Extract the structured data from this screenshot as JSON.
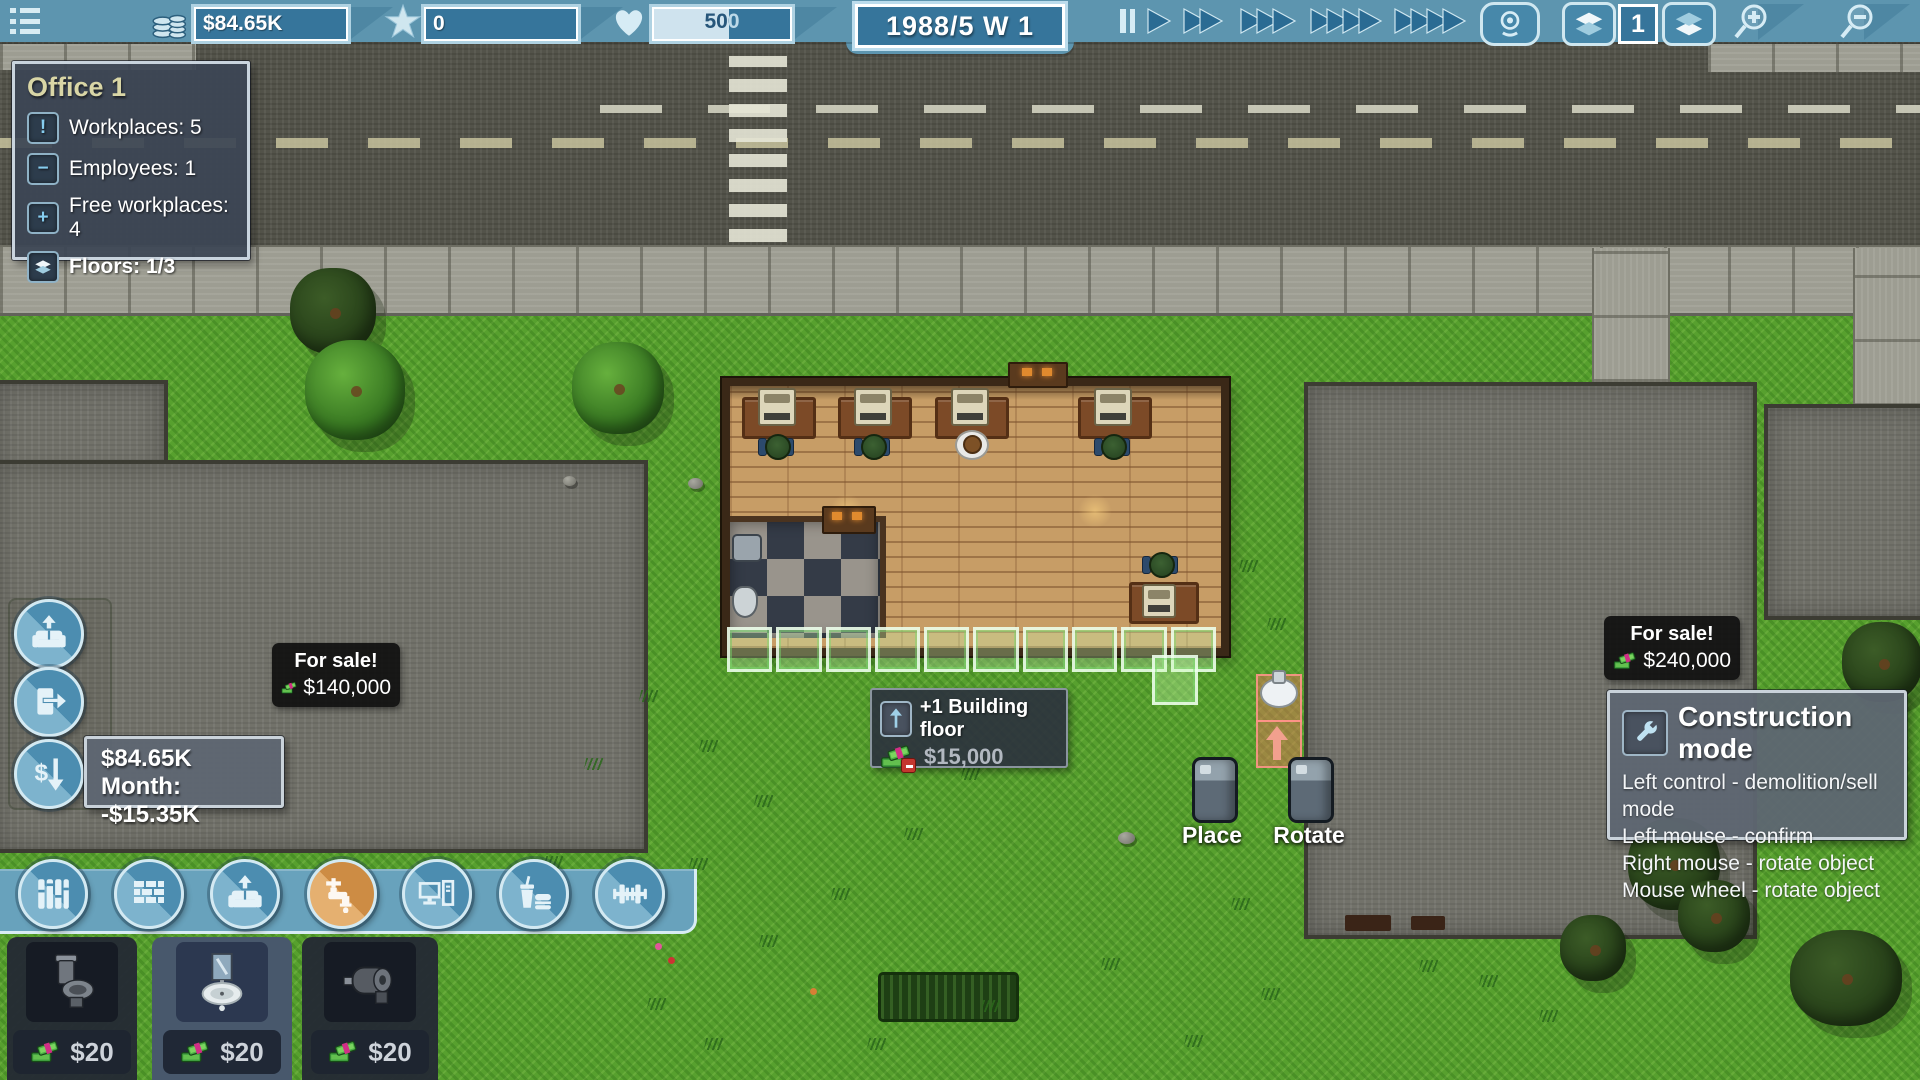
{
  "topbar": {
    "money": "$84.65K",
    "reputation": "0",
    "health": "500",
    "health_fill_pct": 55,
    "date": "1988/5 W 1",
    "floor": "1"
  },
  "office_panel": {
    "title": "Office 1",
    "rows": [
      {
        "icon": "exclamation",
        "label": "Workplaces: 5"
      },
      {
        "icon": "minus",
        "label": "Employees: 1"
      },
      {
        "icon": "plus",
        "label": "Free workplaces: 4"
      },
      {
        "icon": "layers",
        "label": "Floors: 1/3"
      }
    ]
  },
  "finance": {
    "balance": "$84.65K",
    "month": "Month: -$15.35K"
  },
  "sale_left": {
    "title": "For sale!",
    "price": "$140,000"
  },
  "sale_right": {
    "title": "For sale!",
    "price": "$240,000"
  },
  "floor_tooltip": {
    "label": "+1 Building floor",
    "price": "$15,000"
  },
  "construction": {
    "title": "Construction mode",
    "lines": [
      "Left control - demolition/sell mode",
      "Left mouse - confirm",
      "Right mouse - rotate object",
      "Mouse wheel - rotate object"
    ]
  },
  "touch": {
    "place": "Place",
    "rotate": "Rotate"
  },
  "toolbar": {
    "categories": [
      "flooring",
      "walls",
      "furniture",
      "plumbing",
      "electronics",
      "food",
      "fitness"
    ],
    "selected": "plumbing"
  },
  "shop": {
    "selected_index": 1,
    "items": [
      {
        "name": "toilet",
        "price": "$20"
      },
      {
        "name": "sink",
        "price": "$20"
      },
      {
        "name": "toilet-paper-holder",
        "price": "$20"
      }
    ]
  },
  "colors": {
    "topbar": "#5d95af",
    "field": "#36759b",
    "accent_orange": "#cd8c44",
    "panel_gray": "#5e6672",
    "tooltip_black": "#0a0a0a",
    "highlight_green": "rgba(205,255,185,0.35)",
    "ghost_red": "rgba(240,108,92,0.45)"
  }
}
